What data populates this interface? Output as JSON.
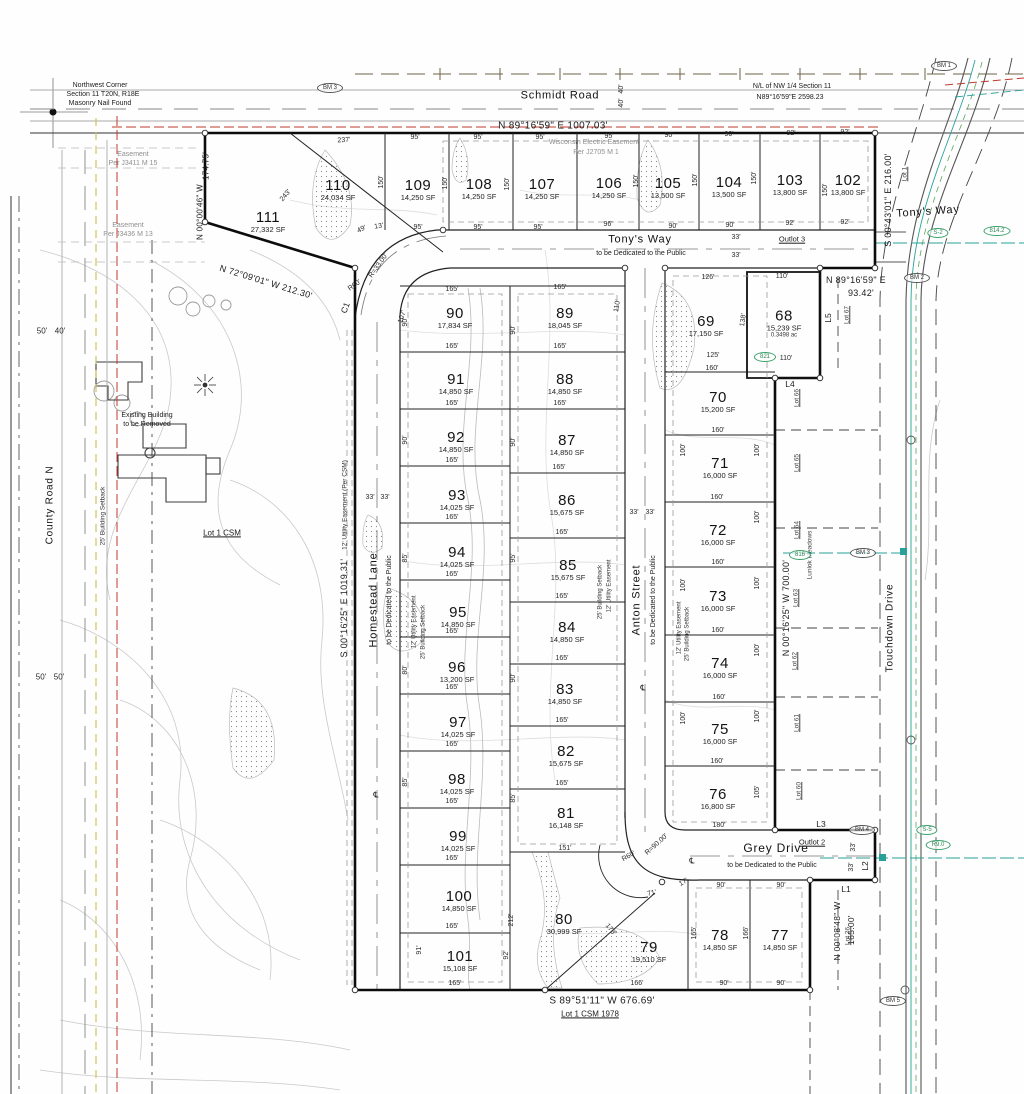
{
  "corner_note": {
    "l1": "Northwest Corner",
    "l2": "Section 11 T20N, R18E",
    "l3": "Masonry Nail Found"
  },
  "section_note": {
    "l1": "N/L of NW 1/4 Section 11",
    "l2": "N89°16'59\"E  2598.23"
  },
  "roads": {
    "schmidt": "Schmidt Road",
    "tonys_way": "Tony's Way",
    "tonys_way_right": "Tony's Way",
    "homestead": "Homestead Lane",
    "anton": "Anton Street",
    "grey": "Grey Drive",
    "touchdown": "Touchdown Drive",
    "county": "County Road N",
    "dedication": "to be Dedicated to the Public"
  },
  "bearings": {
    "top": "N 89°16'59\" E    1007.03'",
    "west_upper_dist": "174.75'",
    "west_upper": "N 00°00'46\" W",
    "diag": "N 72°09'01\" W    212.30'",
    "west": "S 00°16'25\" E    1019.31'",
    "east_68_1": "N 89°16'59\" E",
    "east_68_2": "93.42'",
    "east_right": "S 00°43'01\" E    216.00'",
    "east_col": "N 00°16'25\" W    700.00'",
    "bottom": "S 89°51'11\" W    676.69'",
    "east_77": "N 00°08'48\" W",
    "east_77_dist": "165.00'",
    "r33": "R=33.00'",
    "r60a": "R60'",
    "r90": "R=90.00'",
    "r60b": "R60'"
  },
  "notes": {
    "wisconsin_1": "Wisconsin Electric Easement",
    "wisconsin_2": "Per J2705 M 1",
    "easement1_1": "Easement",
    "easement1_2": "Per J3411 M 15",
    "easement2_1": "Easement",
    "easement2_2": "Per J3436 M 13",
    "existing_1": "Existing Building",
    "existing_2": "to be Removed",
    "lot1_csm": "Lot 1 CSM",
    "lot1_csm_1978": "Lot 1 CSM 1978",
    "outlot3": "Outlot 3",
    "outlot2": "Outlot 2",
    "lot1_vert": "Lot 1",
    "utility": "12' Utility Easement",
    "setback": "25' Building Setback",
    "utility_csm": "12' Utility Easement (Per CSM)",
    "meadows": "Lunlok Meadows",
    "cl": "℄"
  },
  "adjacent_lots": {
    "lot67": "Lot 67",
    "lot66": "Lot 66",
    "lot65": "Lot 65",
    "lot64": "Lot 64",
    "lot63": "Lot 63",
    "lot62": "Lot 62",
    "lot61": "Lot 61",
    "lot60": "Lot 60",
    "lot26": "Lot 26"
  },
  "line_labels": {
    "l1": "L1",
    "l2": "L2",
    "l3": "L3",
    "l4": "L4",
    "l5": "L5",
    "c1": "C1"
  },
  "benchmarks": {
    "bm3a": "BM 3",
    "bm1": "BM 1",
    "bm2": "BM 2",
    "bm3b": "BM 3",
    "bm4": "BM 4",
    "bm5": "BM 5"
  },
  "green_labels": {
    "g1": "S-2",
    "g2": "814.2",
    "g3": "821",
    "g4": "816",
    "g5": "S-5",
    "g6": "R9.0"
  },
  "lots": [
    {
      "num": "111",
      "sf": "27,332 SF"
    },
    {
      "num": "110",
      "sf": "24,034 SF"
    },
    {
      "num": "109",
      "sf": "14,250 SF"
    },
    {
      "num": "108",
      "sf": "14,250 SF"
    },
    {
      "num": "107",
      "sf": "14,250 SF"
    },
    {
      "num": "106",
      "sf": "14,250 SF"
    },
    {
      "num": "105",
      "sf": "13,500 SF"
    },
    {
      "num": "104",
      "sf": "13,500 SF"
    },
    {
      "num": "103",
      "sf": "13,800 SF"
    },
    {
      "num": "102",
      "sf": "13,800 SF"
    },
    {
      "num": "90",
      "sf": "17,834 SF"
    },
    {
      "num": "91",
      "sf": "14,850 SF"
    },
    {
      "num": "92",
      "sf": "14,850 SF"
    },
    {
      "num": "93",
      "sf": "14,025 SF"
    },
    {
      "num": "94",
      "sf": "14,025 SF"
    },
    {
      "num": "95",
      "sf": "14,850 SF"
    },
    {
      "num": "96",
      "sf": "13,200 SF"
    },
    {
      "num": "97",
      "sf": "14,025 SF"
    },
    {
      "num": "98",
      "sf": "14,025 SF"
    },
    {
      "num": "99",
      "sf": "14,025 SF"
    },
    {
      "num": "100",
      "sf": "14,850 SF"
    },
    {
      "num": "101",
      "sf": "15,108 SF"
    },
    {
      "num": "89",
      "sf": "18,045 SF"
    },
    {
      "num": "88",
      "sf": "14,850 SF"
    },
    {
      "num": "87",
      "sf": "14,850 SF"
    },
    {
      "num": "86",
      "sf": "15,675 SF"
    },
    {
      "num": "85",
      "sf": "15,675 SF"
    },
    {
      "num": "84",
      "sf": "14,850 SF"
    },
    {
      "num": "83",
      "sf": "14,850 SF"
    },
    {
      "num": "82",
      "sf": "15,675 SF"
    },
    {
      "num": "81",
      "sf": "16,148 SF"
    },
    {
      "num": "80",
      "sf": "30,999 SF"
    },
    {
      "num": "69",
      "sf": "17,150 SF"
    },
    {
      "num": "68",
      "sf": "15,239 SF",
      "ac": "0.3498 ac"
    },
    {
      "num": "70",
      "sf": "15,200 SF"
    },
    {
      "num": "71",
      "sf": "16,000 SF"
    },
    {
      "num": "72",
      "sf": "16,000 SF"
    },
    {
      "num": "73",
      "sf": "16,000 SF"
    },
    {
      "num": "74",
      "sf": "16,000 SF"
    },
    {
      "num": "75",
      "sf": "16,000 SF"
    },
    {
      "num": "76",
      "sf": "16,800 SF"
    },
    {
      "num": "79",
      "sf": "19,510 SF"
    },
    {
      "num": "78",
      "sf": "14,850 SF"
    },
    {
      "num": "77",
      "sf": "14,850 SF"
    }
  ],
  "dims": [
    "237'",
    "95'",
    "95'",
    "95'",
    "95'",
    "90'",
    "90'",
    "92'",
    "92'",
    "243'",
    "150'",
    "150'",
    "150'",
    "150'",
    "150'",
    "150'",
    "150'",
    "49'",
    "13'",
    "95'",
    "95'",
    "95'",
    "96'",
    "90'",
    "90'",
    "92'",
    "92'",
    "33'",
    "33'",
    "165'",
    "165'",
    "107'",
    "110'",
    "165'",
    "165'",
    "165'",
    "165'",
    "165'",
    "165'",
    "165'",
    "165'",
    "165'",
    "165'",
    "165'",
    "165'",
    "165'",
    "165'",
    "165'",
    "165'",
    "165'",
    "151'",
    "165'",
    "165'",
    "165'",
    "126'",
    "110'",
    "125'",
    "160'",
    "110'",
    "138'",
    "160'",
    "160'",
    "160'",
    "160'",
    "160'",
    "160'",
    "180'",
    "100'",
    "100'",
    "100'",
    "100'",
    "100'",
    "105'",
    "90'",
    "90'",
    "85'",
    "80'",
    "85'",
    "91'",
    "90'",
    "90'",
    "95'",
    "90'",
    "85'",
    "17'",
    "71'",
    "90'",
    "90'",
    "166'",
    "90'",
    "90'",
    "165'",
    "166'",
    "178'",
    "212'",
    "92'",
    "33'",
    "33'",
    "33'",
    "33'",
    "33'",
    "33'",
    "50'",
    "40'",
    "50'",
    "50'",
    "40'",
    "40'",
    "100'",
    "100'",
    "100'"
  ]
}
